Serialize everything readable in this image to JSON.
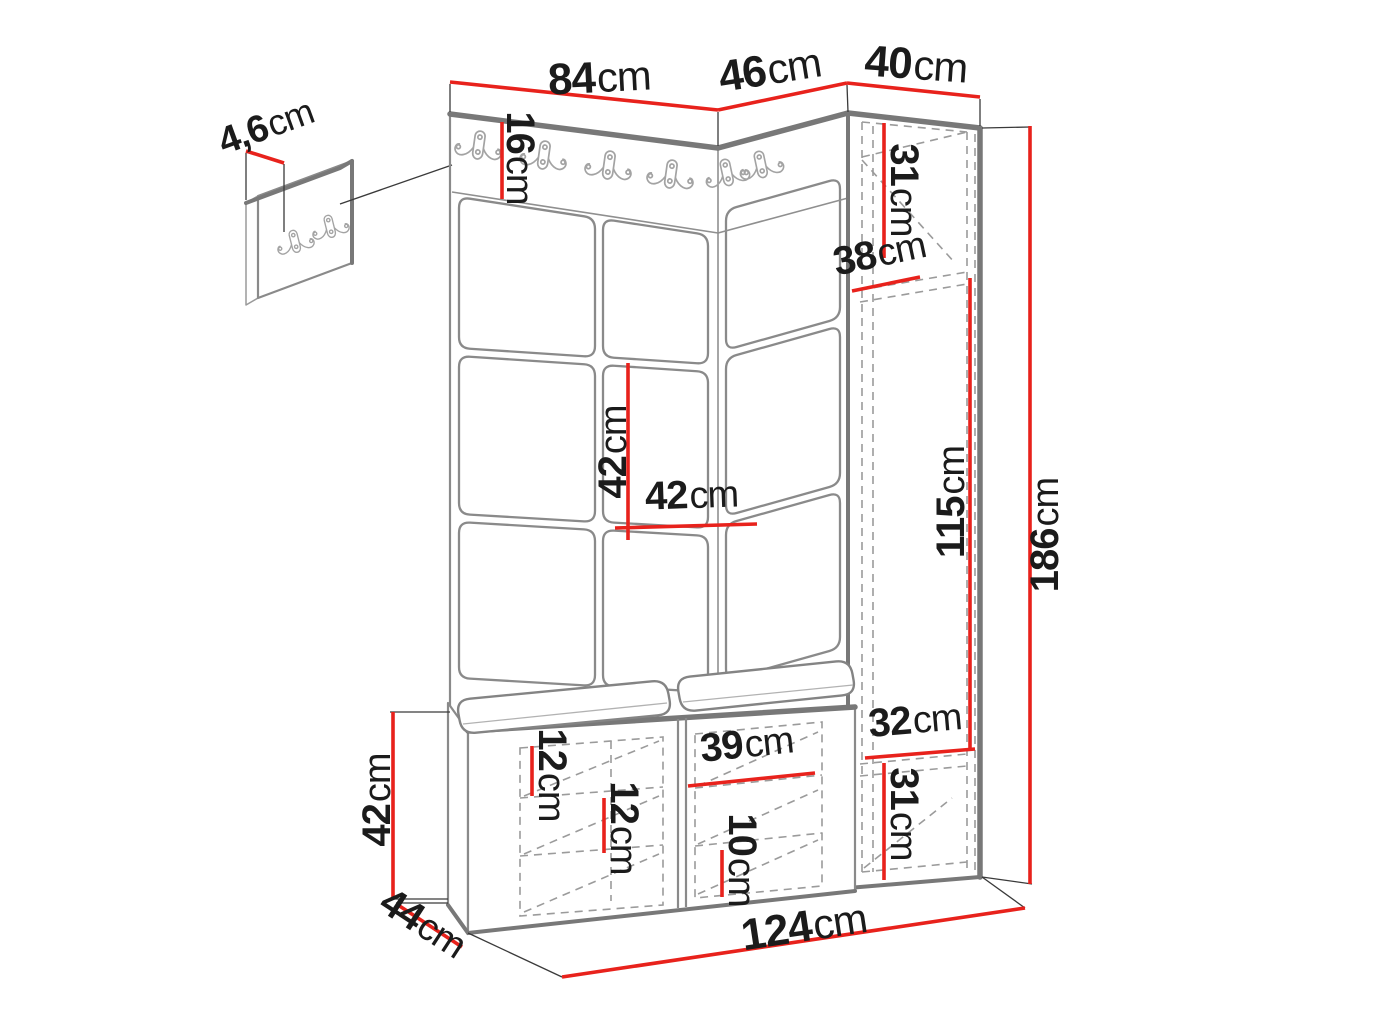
{
  "diagram": {
    "kind": "furniture-dimension-drawing",
    "unit": "cm"
  },
  "dims": {
    "w84": {
      "value": "84",
      "unit": "cm"
    },
    "w46": {
      "value": "46",
      "unit": "cm"
    },
    "w40": {
      "value": "40",
      "unit": "cm"
    },
    "d46": {
      "value": "4,6",
      "unit": "cm"
    },
    "h16": {
      "value": "16",
      "unit": "cm"
    },
    "h31t": {
      "value": "31",
      "unit": "cm"
    },
    "w38": {
      "value": "38",
      "unit": "cm"
    },
    "h42m": {
      "value": "42",
      "unit": "cm"
    },
    "w42m": {
      "value": "42",
      "unit": "cm"
    },
    "h115": {
      "value": "115",
      "unit": "cm"
    },
    "h186": {
      "value": "186",
      "unit": "cm"
    },
    "w32": {
      "value": "32",
      "unit": "cm"
    },
    "h31b": {
      "value": "31",
      "unit": "cm"
    },
    "w39": {
      "value": "39",
      "unit": "cm"
    },
    "h10": {
      "value": "10",
      "unit": "cm"
    },
    "h12a": {
      "value": "12",
      "unit": "cm"
    },
    "h12b": {
      "value": "12",
      "unit": "cm"
    },
    "h42l": {
      "value": "42",
      "unit": "cm"
    },
    "w44": {
      "value": "44",
      "unit": "cm"
    },
    "w124": {
      "value": "124",
      "unit": "cm"
    }
  },
  "colors": {
    "dimension_line": "#e8221c",
    "outline": "#787878",
    "hidden_line": "#9b9b9b",
    "label_text": "#1b1b1b",
    "background": "#ffffff"
  }
}
